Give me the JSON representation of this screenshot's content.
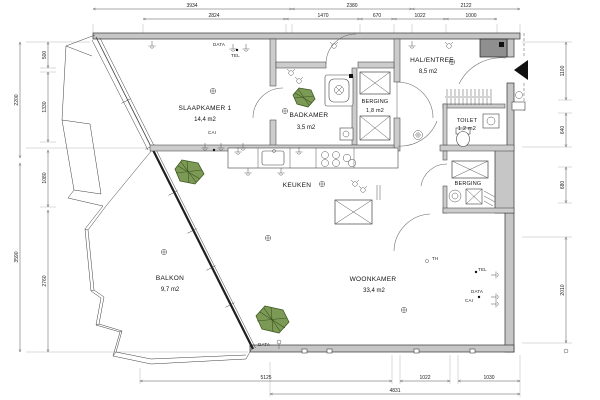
{
  "rooms": {
    "slaapkamer": {
      "name": "SLAAPKAMER 1",
      "area": "14,4 m2"
    },
    "badkamer": {
      "name": "BADKAMER",
      "area": "3,5 m2"
    },
    "berging1": {
      "name": "BERGING",
      "area": "1,8 m2"
    },
    "hal": {
      "name": "HAL/ENTREE",
      "area": "8,5 m2"
    },
    "toilet": {
      "name": "TOILET",
      "area": "1,2 m2"
    },
    "berging2": {
      "name": "BERGING"
    },
    "keuken": {
      "name": "KEUKEN"
    },
    "woonkamer": {
      "name": "WOONKAMER",
      "area": "33,4 m2"
    },
    "balkon": {
      "name": "BALKON",
      "area": "9,7 m2"
    }
  },
  "labels": {
    "data": "DATA",
    "tel": "TEL",
    "cai": "CAI",
    "th": "TH"
  },
  "dims": {
    "top_row1": [
      "3934",
      "2380",
      "2122"
    ],
    "top_row2": [
      "2824",
      "1470",
      "670",
      "1022",
      "1000"
    ],
    "bottom_row1": [
      "5125",
      "1022",
      "1030"
    ],
    "bottom_row2": [
      "4831"
    ],
    "left_outer": [
      "2200",
      "3590"
    ],
    "left_inner": [
      "500",
      "1330",
      "1080",
      "2760"
    ],
    "right": [
      "1100",
      "640",
      "680",
      "2010"
    ]
  },
  "colors": {
    "background": "#ffffff",
    "line": "#3c3c3c",
    "wall_fill": "#c6c6c6",
    "wall_dark": "#8f8f8f",
    "plant_fill": "#7c9a55",
    "plant_stroke": "#3f5a22",
    "entry_arrow": "#111111"
  }
}
